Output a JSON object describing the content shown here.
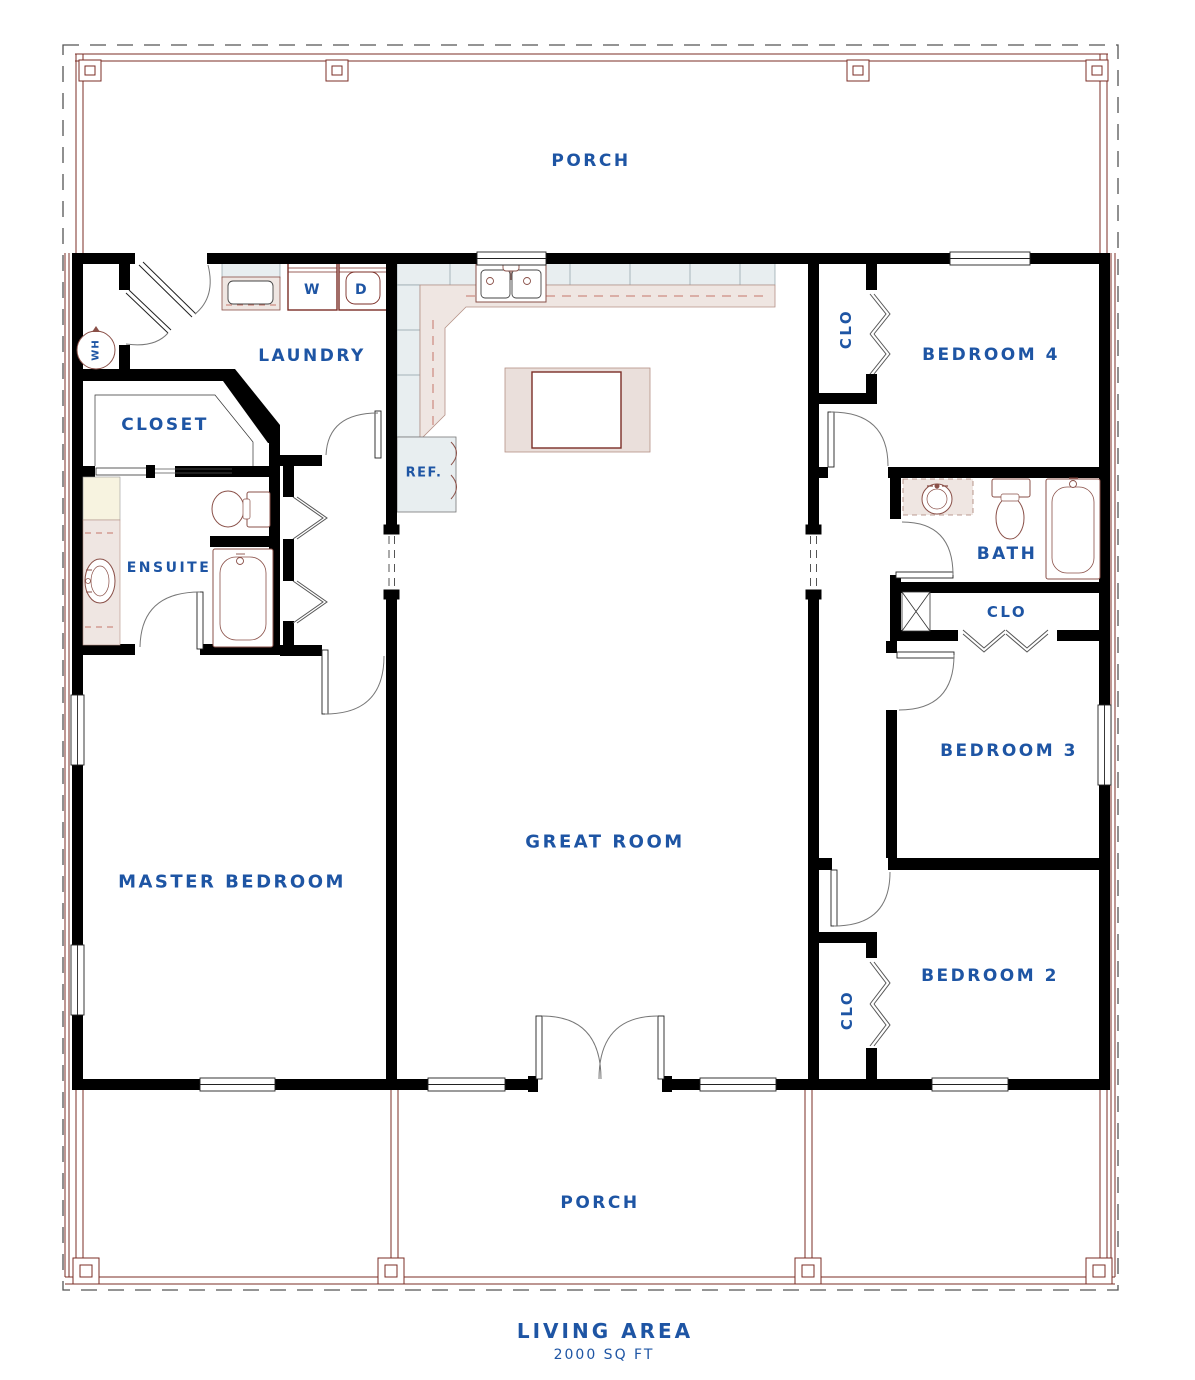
{
  "plan": {
    "footer": {
      "title": "LIVING AREA",
      "area": "2000 SQ FT"
    },
    "labels": {
      "porch_top": "PORCH",
      "porch_bottom": "PORCH",
      "laundry": "LAUNDRY",
      "closet": "CLOSET",
      "ensuite": "ENSUITE",
      "master_bedroom": "MASTER BEDROOM",
      "great_room": "GREAT ROOM",
      "bedroom_4": "BEDROOM 4",
      "bedroom_3": "BEDROOM 3",
      "bedroom_2": "BEDROOM 2",
      "bath": "BATH",
      "closet_bed4": "CLO",
      "closet_bath": "CLO",
      "closet_bed2": "CLO",
      "refrigerator": "REF.",
      "washer": "W",
      "dryer": "D",
      "water_heater": "WH"
    },
    "colors": {
      "wall": "#000000",
      "porch_line": "#7b2d26",
      "fixture_line": "#8a5048",
      "label_text": "#1e55a4",
      "counter_fill": "#efe6e2",
      "cabinet_fill": "#e8eef0",
      "cream_fill": "#f7f3e0",
      "boundary_dash": "#555555"
    }
  }
}
